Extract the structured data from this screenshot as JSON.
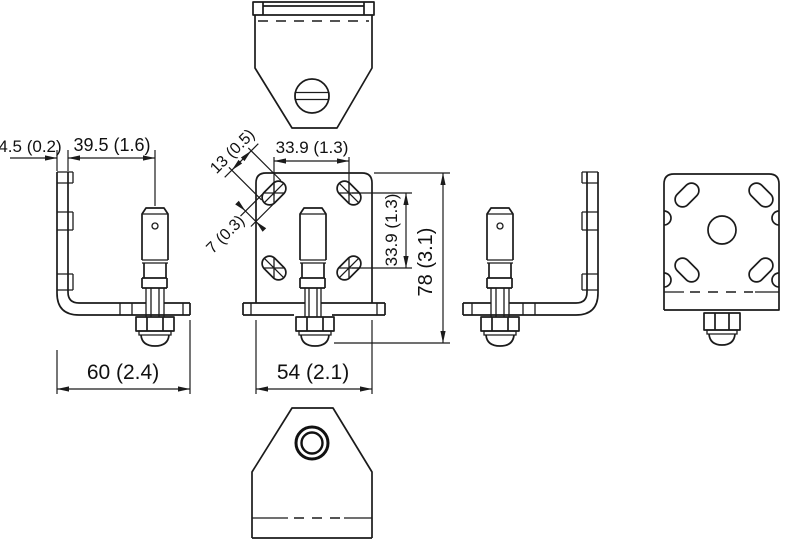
{
  "drawing": {
    "dimensions": {
      "flange_thickness": "4.5 (0.2)",
      "sensor_offset": "39.5 (1.6)",
      "slot_length": "13 (0.5)",
      "slot_width": "7 (0.3)",
      "slot_pitch_horizontal": "33.9 (1.3)",
      "slot_pitch_vertical": "33.9 (1.3)",
      "overall_height": "78 (3.1)",
      "base_depth": "60 (2.4)",
      "plate_width": "54 (2.1)"
    }
  }
}
